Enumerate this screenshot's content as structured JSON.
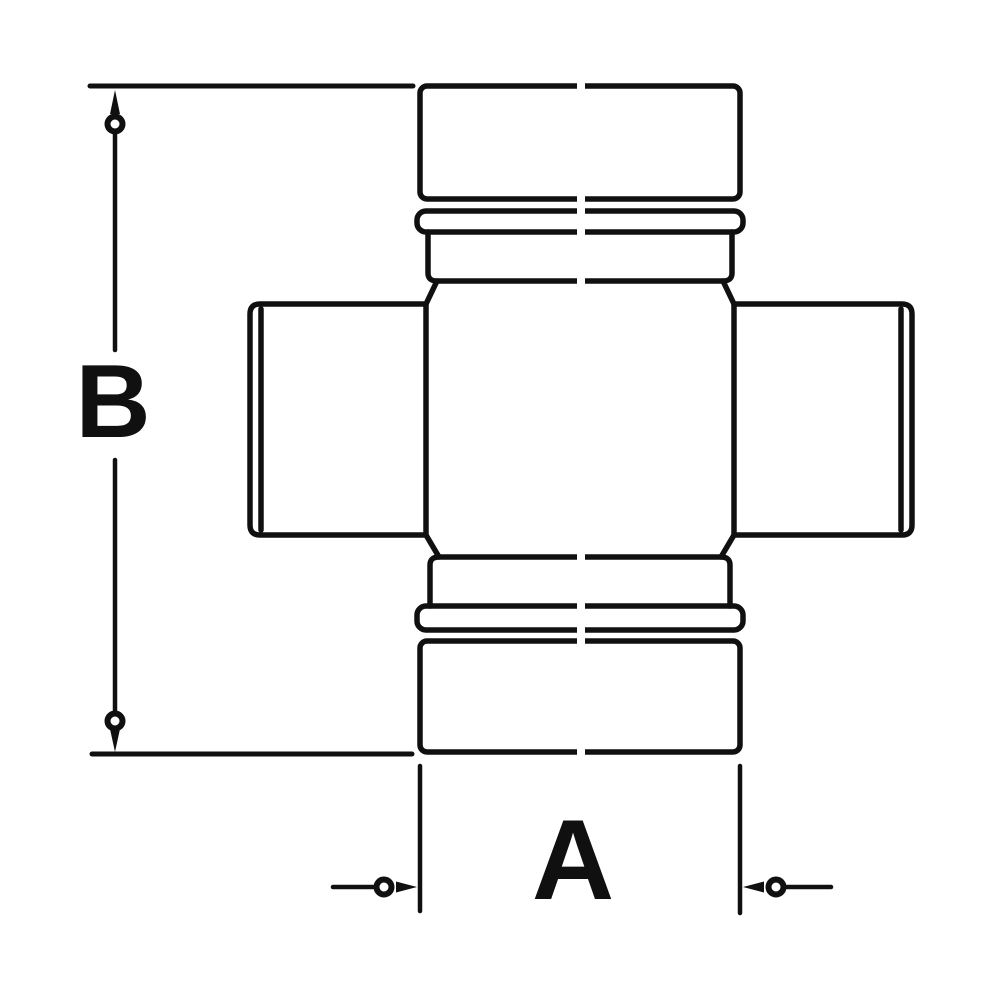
{
  "diagram": {
    "labels": {
      "dim_vertical": "B",
      "dim_horizontal": "A"
    },
    "colors": {
      "line": "#101010",
      "background": "#ffffff"
    }
  }
}
